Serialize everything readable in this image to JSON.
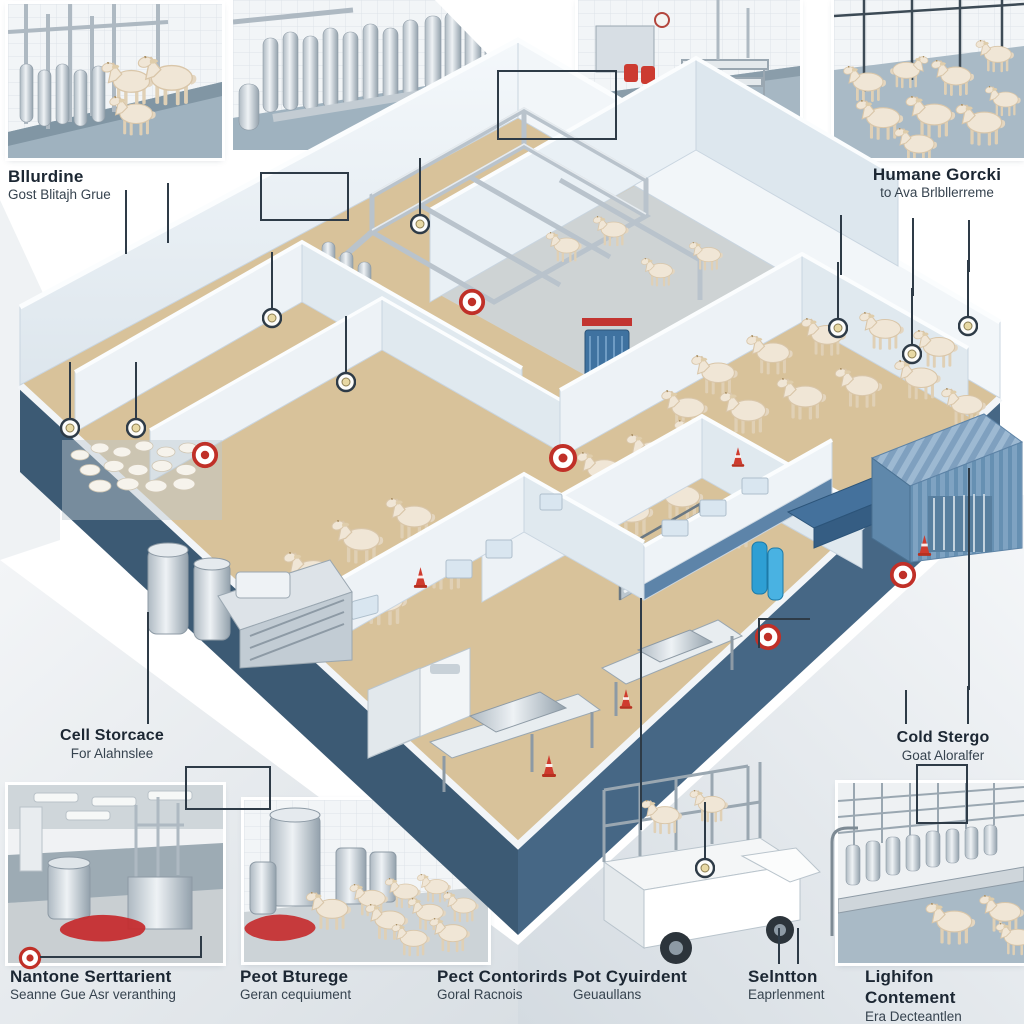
{
  "page": {
    "background": "#ffffff",
    "kind": "isometric-facility-infographic"
  },
  "palette": {
    "plinth_dark_blue": "#3c5a74",
    "plinth_side": "#33506a",
    "floor_tan": "#d8c29a",
    "wall_white": "#edf2f6",
    "wall_shade": "#c7d4df",
    "wainscot_blue": "#44719c",
    "steel_gray": "#b8c2cb",
    "steel_light": "#e6ebef",
    "shed_blue": "#7fa3c2",
    "accent_red": "#c23430",
    "ground_gray": "#e4e9ed",
    "goat_cream": "#f0e6d6",
    "label_text": "#1c2733"
  },
  "callouts": {
    "top_left": {
      "title": "Bllurdine",
      "subtitle": "Gost Blitajh Grue"
    },
    "top_right": {
      "title": "Humane Gorcki",
      "subtitle": "to Ava Brlbllerreme"
    },
    "mid_left": {
      "title": "Cell Storcace",
      "subtitle": "For Alahnslee"
    },
    "mid_right": {
      "title": "Cold Stergo",
      "subtitle": "Goat Aloralfer"
    },
    "bottom": [
      {
        "title": "Nantone Serttarient",
        "subtitle": "Seanne Gue Asr veranthing"
      },
      {
        "title": "Peot Bturege",
        "subtitle": "Geran cequiument"
      },
      {
        "title": "Pect Contorirds",
        "subtitle": "Goral Racnois"
      },
      {
        "title": "Pot Cyuirdent",
        "subtitle": "Geuaullans"
      },
      {
        "title": "Selntton",
        "subtitle": "Eaprlenment"
      },
      {
        "title": "Lighifon Contement",
        "subtitle": "Era Decteantlen"
      }
    ]
  },
  "icons": {
    "ring_marker": "red-ring-marker-icon",
    "lamp": "hanging-lamp-icon",
    "cone": "traffic-cone-icon"
  }
}
